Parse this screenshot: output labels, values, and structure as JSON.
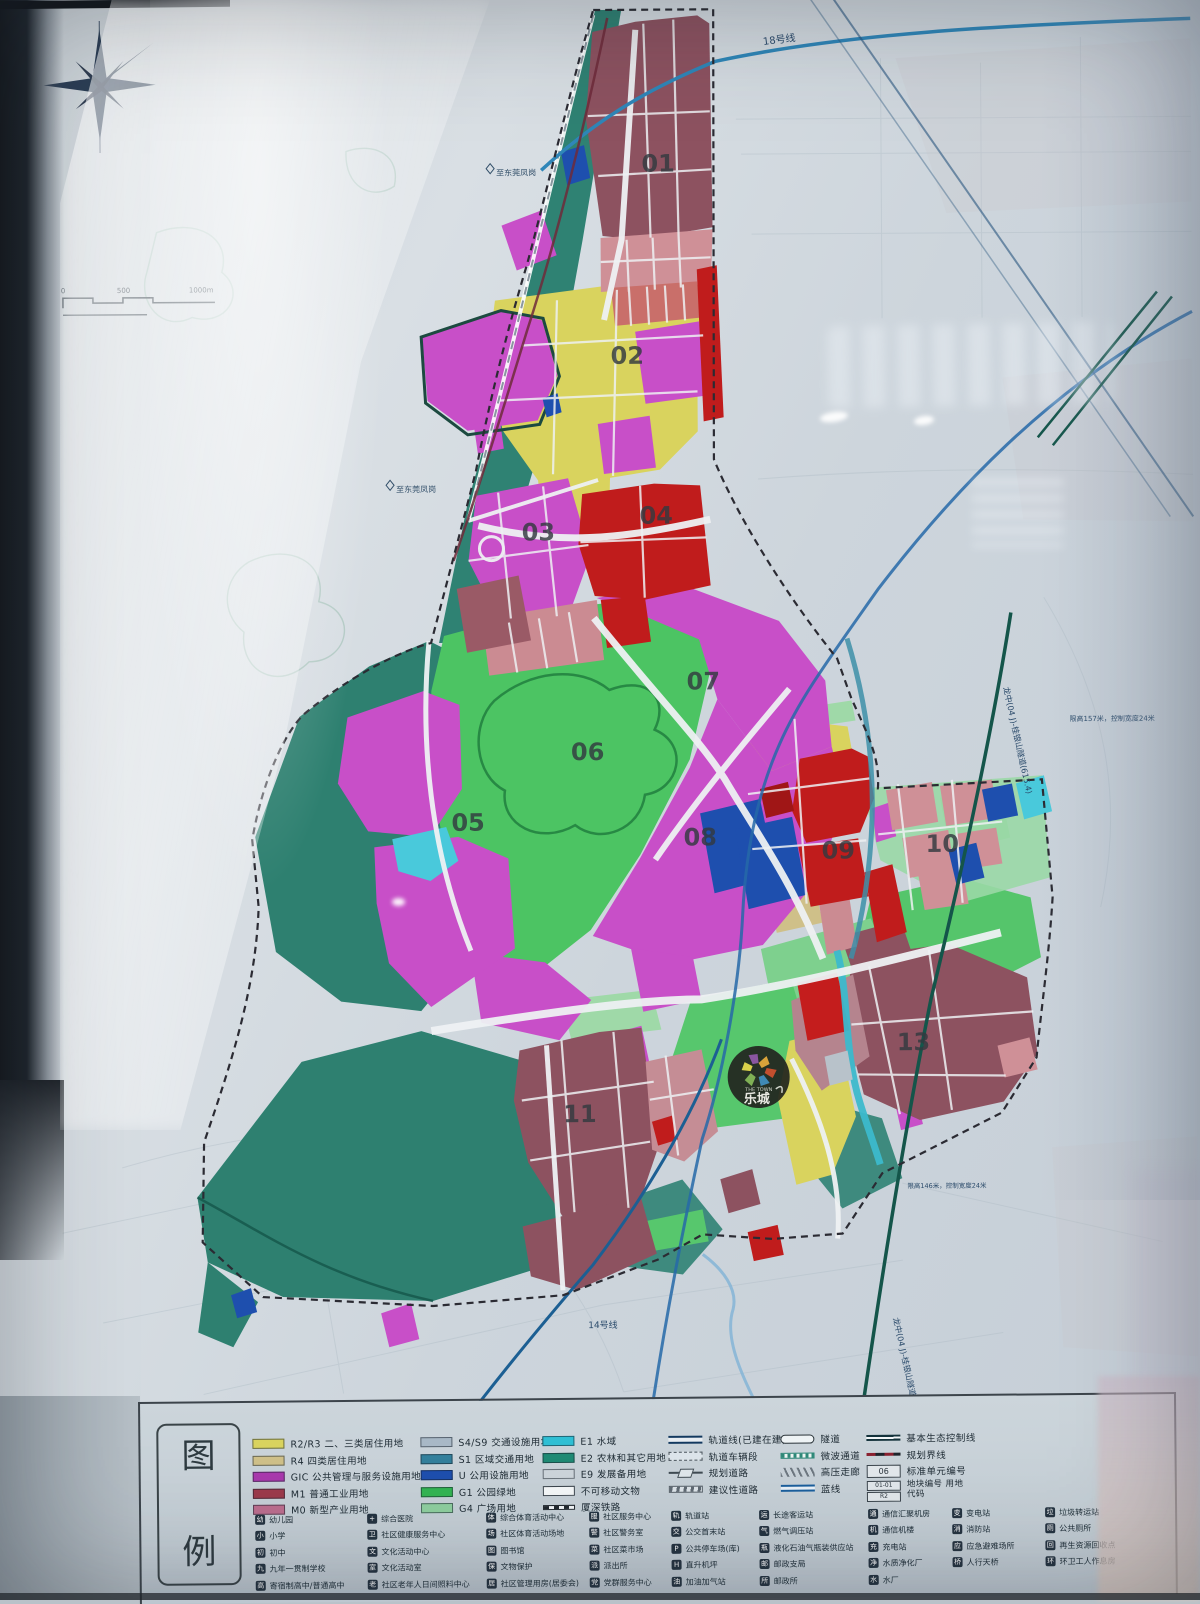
{
  "map": {
    "districts": [
      {
        "num": "01",
        "x": 662,
        "y": 172
      },
      {
        "num": "02",
        "x": 630,
        "y": 364
      },
      {
        "num": "03",
        "x": 540,
        "y": 540
      },
      {
        "num": "04",
        "x": 658,
        "y": 524
      },
      {
        "num": "05",
        "x": 468,
        "y": 830
      },
      {
        "num": "06",
        "x": 588,
        "y": 760
      },
      {
        "num": "07",
        "x": 704,
        "y": 690
      },
      {
        "num": "08",
        "x": 700,
        "y": 846
      },
      {
        "num": "09",
        "x": 838,
        "y": 860
      },
      {
        "num": "10",
        "x": 942,
        "y": 854
      },
      {
        "num": "11",
        "x": 578,
        "y": 1122
      },
      {
        "num": "13",
        "x": 912,
        "y": 1052
      }
    ],
    "labels": {
      "line18": "18号线",
      "line14": "14号线",
      "to_fenggang": "至东莞凤岗",
      "tunnel": "龙中(04 J)-桂银山隧道(615.4)",
      "note_right": "限高157米，控制宽度24米",
      "note_bottom": "限高146米，控制宽度24米",
      "scale": [
        "0",
        "500",
        "1000m"
      ]
    },
    "logo": {
      "top": "THE TOWN",
      "name": "乐城"
    }
  },
  "legend": {
    "panel_title": [
      "图",
      "例"
    ],
    "land_use": [
      {
        "code": "R2/R3",
        "label": "二、三类居住用地",
        "color": "#d9d35e"
      },
      {
        "code": "R4",
        "label": "四类居住用地",
        "color": "#cfc089"
      },
      {
        "code": "GIC",
        "label": "公共管理与服务设施用地",
        "color": "#a939ad"
      },
      {
        "code": "M1",
        "label": "普通工业用地",
        "color": "#9c3a4c"
      },
      {
        "code": "M0",
        "label": "新型产业用地",
        "color": "#bd6e8e"
      },
      {
        "code": "S4/S9",
        "label": "交通设施用地",
        "color": "#a8b8c6"
      },
      {
        "code": "S1",
        "label": "区域交通用地",
        "color": "#33809c"
      },
      {
        "code": "U",
        "label": "公用设施用地",
        "color": "#1e4fae"
      },
      {
        "code": "G1",
        "label": "公园绿地",
        "color": "#33b553"
      },
      {
        "code": "G4",
        "label": "广场用地",
        "color": "#8fcf9f"
      },
      {
        "code": "E1",
        "label": "水域",
        "color": "#2fbfd4"
      },
      {
        "code": "E2",
        "label": "农林和其它用地",
        "color": "#1f8a74"
      },
      {
        "code": "E9",
        "label": "发展备用地",
        "color": "#ccd4da"
      },
      {
        "code": "",
        "label": "不可移动文物",
        "color": "#f4f7f8",
        "swatch": "relic"
      },
      {
        "code": "",
        "label": "厦深铁路",
        "color": "",
        "swatch": "railway"
      }
    ],
    "line_symbols": [
      {
        "label": "轨道线(已建在建)",
        "type": "rail-line"
      },
      {
        "label": "轨道车辆段",
        "type": "depot"
      },
      {
        "label": "规划道路",
        "type": "planned-road"
      },
      {
        "label": "建议性道路",
        "type": "suggested-road"
      },
      {
        "label": "隧道",
        "type": "tunnel"
      },
      {
        "label": "微波通道",
        "type": "microwave"
      },
      {
        "label": "高压走廊",
        "type": "hv-corridor"
      },
      {
        "label": "蓝线",
        "type": "blue-line"
      },
      {
        "label": "基本生态控制线",
        "type": "eco-line"
      },
      {
        "label": "规划界线",
        "type": "boundary"
      },
      {
        "label": "标准单元编号",
        "type": "unit-no",
        "text": "06"
      },
      {
        "label": "地块编号 用地代码",
        "type": "plot-no",
        "text": "01-01",
        "text2": "R2"
      }
    ],
    "facilities": [
      [
        {
          "label": "幼儿园",
          "icon": "幼"
        },
        {
          "label": "小学",
          "icon": "小"
        },
        {
          "label": "初中",
          "icon": "初"
        },
        {
          "label": "九年一贯制学校",
          "icon": "九"
        },
        {
          "label": "寄宿制高中/普通高中",
          "icon": "高"
        }
      ],
      [
        {
          "label": "综合医院",
          "icon": "+"
        },
        {
          "label": "社区健康服务中心",
          "icon": "卫"
        },
        {
          "label": "文化活动中心",
          "icon": "文"
        },
        {
          "label": "文化活动室",
          "icon": "室"
        },
        {
          "label": "社区老年人日间照料中心",
          "icon": "老"
        }
      ],
      [
        {
          "label": "综合体育活动中心",
          "icon": "体"
        },
        {
          "label": "社区体育活动场地",
          "icon": "场"
        },
        {
          "label": "图书馆",
          "icon": "图"
        },
        {
          "label": "文物保护",
          "icon": "保"
        },
        {
          "label": "社区管理用房(居委会)",
          "icon": "居"
        }
      ],
      [
        {
          "label": "社区服务中心",
          "icon": "服"
        },
        {
          "label": "社区警务室",
          "icon": "警"
        },
        {
          "label": "社区菜市场",
          "icon": "菜"
        },
        {
          "label": "派出所",
          "icon": "派"
        },
        {
          "label": "党群服务中心",
          "icon": "党"
        }
      ],
      [
        {
          "label": "轨道站",
          "icon": "轨"
        },
        {
          "label": "公交首末站",
          "icon": "交"
        },
        {
          "label": "公共停车场(库)",
          "icon": "P"
        },
        {
          "label": "直升机坪",
          "icon": "H"
        },
        {
          "label": "加油加气站",
          "icon": "油"
        }
      ],
      [
        {
          "label": "长途客运站",
          "icon": "运"
        },
        {
          "label": "燃气调压站",
          "icon": "气"
        },
        {
          "label": "液化石油气瓶装供应站",
          "icon": "瓶"
        },
        {
          "label": "邮政支局",
          "icon": "邮"
        },
        {
          "label": "邮政所",
          "icon": "所"
        }
      ],
      [
        {
          "label": "通信汇聚机房",
          "icon": "通"
        },
        {
          "label": "通信机楼",
          "icon": "机"
        },
        {
          "label": "充电站",
          "icon": "充"
        },
        {
          "label": "水质净化厂",
          "icon": "净"
        },
        {
          "label": "水厂",
          "icon": "水"
        }
      ],
      [
        {
          "label": "变电站",
          "icon": "变"
        },
        {
          "label": "消防站",
          "icon": "消"
        },
        {
          "label": "应急避难场所",
          "icon": "应"
        },
        {
          "label": "人行天桥",
          "icon": "桥"
        }
      ],
      [
        {
          "label": "垃圾转运站",
          "icon": "垃"
        },
        {
          "label": "公共厕所",
          "icon": "厕"
        },
        {
          "label": "再生资源回收点",
          "icon": "回"
        },
        {
          "label": "环卫工人作息房",
          "icon": "环"
        }
      ]
    ]
  },
  "colors": {
    "residential": "#d9d35e",
    "residential4": "#cfc089",
    "gic": "#c84fc8",
    "industry": "#9c3a4c",
    "industry_new": "#cb8b92",
    "transport": "#a8b8c6",
    "regional_transport": "#33809c",
    "utility": "#1e4fae",
    "park": "#4cc463",
    "plaza": "#9fd9a8",
    "water": "#49c9db",
    "agriculture": "#2e8070",
    "reserve": "#ccd4da",
    "metro": "#2f86b8",
    "eco_line": "#14554a",
    "boundary": "#2b2b33"
  }
}
